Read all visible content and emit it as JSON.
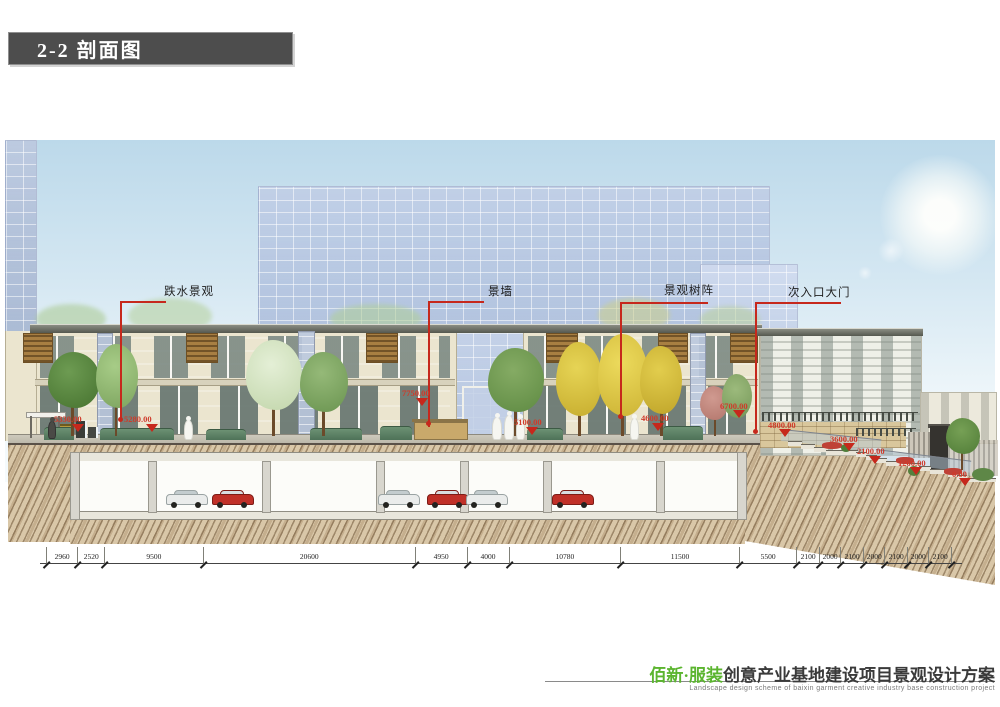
{
  "header": {
    "title": "2-2 剖面图"
  },
  "annotations": {
    "labels": [
      "跌水景观",
      "景墙",
      "景观树阵",
      "次入口大门"
    ],
    "elevations": [
      "5330.00",
      "5280.00",
      "7750.00",
      "5100.00",
      "4600.00",
      "6700.00",
      "4800.00",
      "3600.00",
      "2100.00",
      "1200.00",
      "0.00"
    ]
  },
  "dimensions": {
    "values": [
      "2960",
      "2520",
      "9500",
      "20600",
      "4950",
      "4000",
      "10780",
      "11500",
      "5500",
      "2100",
      "2000",
      "2100",
      "2000",
      "2100",
      "2000",
      "2100"
    ]
  },
  "footer": {
    "brand_green": "佰新·服装",
    "brand_black": "创意产业基地建设项目景观设计方案",
    "caption_en": "Landscape design scheme of baixin garment creative industry base construction project"
  },
  "colors": {
    "annotation_red": "#c6281c",
    "brand_green": "#5bb52f",
    "header_gray": "#4d4d4d"
  }
}
